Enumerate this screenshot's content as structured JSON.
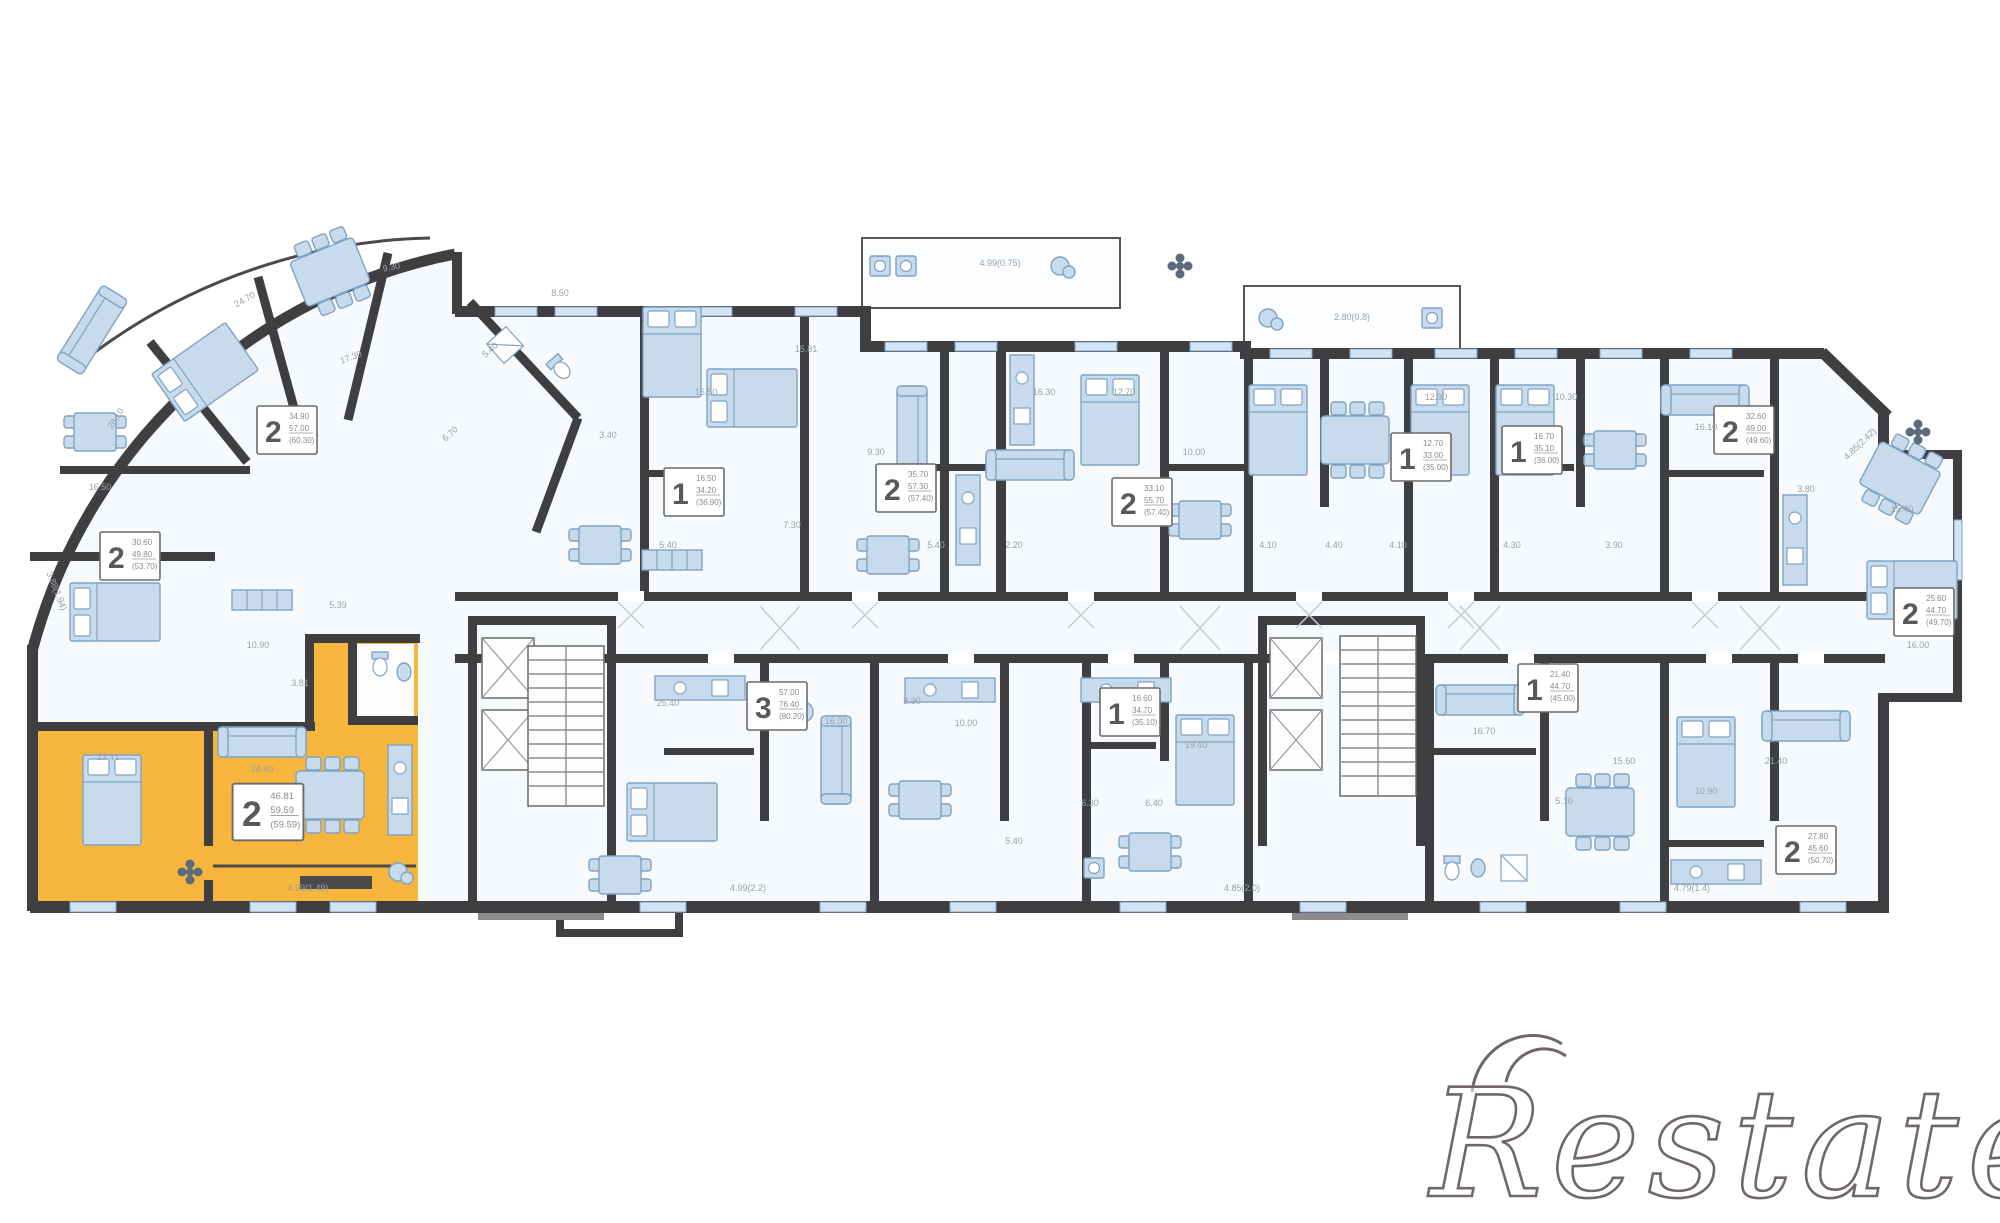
{
  "watermark": {
    "text": "Restate"
  },
  "plan": {
    "colors": {
      "wall": "#3f3f41",
      "furniture": "#c7dbec",
      "highlight": "#F6B53C",
      "dim_text": "#9aa1a8",
      "watermark": "#6f6866"
    },
    "units": [
      {
        "rooms": "2",
        "x": 287,
        "y": 430,
        "lines": [
          "34.90",
          "57.00",
          "(60.30)"
        ],
        "highlight": false
      },
      {
        "rooms": "2",
        "x": 130,
        "y": 556,
        "lines": [
          "30.60",
          "49.80",
          "(53.70)"
        ],
        "highlight": false
      },
      {
        "rooms": "1",
        "x": 694,
        "y": 492,
        "lines": [
          "16.50",
          "34.20",
          "(36.90)"
        ],
        "highlight": false
      },
      {
        "rooms": "2",
        "x": 906,
        "y": 488,
        "lines": [
          "35.70",
          "57.30",
          "(57.40)"
        ],
        "highlight": false
      },
      {
        "rooms": "2",
        "x": 1142,
        "y": 502,
        "lines": [
          "33.10",
          "55.70",
          "(57.40)"
        ],
        "highlight": false
      },
      {
        "rooms": "1",
        "x": 1421,
        "y": 457,
        "lines": [
          "12.70",
          "33.00",
          "(35.00)"
        ],
        "highlight": false
      },
      {
        "rooms": "1",
        "x": 1532,
        "y": 450,
        "lines": [
          "16.70",
          "35.10",
          "(36.00)"
        ],
        "highlight": false
      },
      {
        "rooms": "2",
        "x": 1744,
        "y": 430,
        "lines": [
          "32.60",
          "49.00",
          "(49.60)"
        ],
        "highlight": false
      },
      {
        "rooms": "2",
        "x": 1924,
        "y": 612,
        "lines": [
          "25.60",
          "44.70",
          "(49.70)"
        ],
        "highlight": false
      },
      {
        "rooms": "2",
        "x": 268,
        "y": 812,
        "lines": [
          "46.81",
          "59.59",
          "(59.59)"
        ],
        "highlight": true
      },
      {
        "rooms": "3",
        "x": 777,
        "y": 706,
        "lines": [
          "57.00",
          "76.40",
          "(80.20)"
        ],
        "highlight": false
      },
      {
        "rooms": "1",
        "x": 1130,
        "y": 712,
        "lines": [
          "16.60",
          "34.70",
          "(35.10)"
        ],
        "highlight": false
      },
      {
        "rooms": "1",
        "x": 1548,
        "y": 688,
        "lines": [
          "21.40",
          "44.70",
          "(45.00)"
        ],
        "highlight": false
      },
      {
        "rooms": "2",
        "x": 1806,
        "y": 850,
        "lines": [
          "27.80",
          "45.60",
          "(50.70)"
        ],
        "highlight": false
      }
    ],
    "dims": [
      {
        "t": "28.10",
        "x": 118,
        "y": 420,
        "r": -58
      },
      {
        "t": "24.70",
        "x": 246,
        "y": 302,
        "r": -30
      },
      {
        "t": "9.30",
        "x": 392,
        "y": 270,
        "r": -12
      },
      {
        "t": "17.30",
        "x": 352,
        "y": 360,
        "r": -20
      },
      {
        "t": "16.50",
        "x": 100,
        "y": 490
      },
      {
        "t": "3.88(1.94)",
        "x": 54,
        "y": 592,
        "r": 68
      },
      {
        "t": "10.90",
        "x": 258,
        "y": 648
      },
      {
        "t": "5.39",
        "x": 338,
        "y": 608
      },
      {
        "t": "3.81",
        "x": 300,
        "y": 686
      },
      {
        "t": "23.41",
        "x": 108,
        "y": 760
      },
      {
        "t": "24.40",
        "x": 262,
        "y": 772
      },
      {
        "t": "4.99(1.49)",
        "x": 308,
        "y": 891
      },
      {
        "t": "6.70",
        "x": 452,
        "y": 436,
        "r": -42
      },
      {
        "t": "5.40",
        "x": 492,
        "y": 352,
        "r": -42
      },
      {
        "t": "8.50",
        "x": 560,
        "y": 296
      },
      {
        "t": "3.40",
        "x": 608,
        "y": 438
      },
      {
        "t": "16.50",
        "x": 706,
        "y": 395
      },
      {
        "t": "5.40",
        "x": 668,
        "y": 548
      },
      {
        "t": "7.30",
        "x": 792,
        "y": 528
      },
      {
        "t": "15.81",
        "x": 806,
        "y": 352
      },
      {
        "t": "9.30",
        "x": 876,
        "y": 455
      },
      {
        "t": "5.40",
        "x": 936,
        "y": 548
      },
      {
        "t": "2.20",
        "x": 1014,
        "y": 548
      },
      {
        "t": "16.30",
        "x": 1044,
        "y": 395
      },
      {
        "t": "12.70",
        "x": 1124,
        "y": 395
      },
      {
        "t": "10.00",
        "x": 1194,
        "y": 455
      },
      {
        "t": "4.10",
        "x": 1268,
        "y": 548
      },
      {
        "t": "4.40",
        "x": 1334,
        "y": 548
      },
      {
        "t": "4.10",
        "x": 1398,
        "y": 548
      },
      {
        "t": "12.30",
        "x": 1436,
        "y": 400
      },
      {
        "t": "4.30",
        "x": 1512,
        "y": 548
      },
      {
        "t": "10.30",
        "x": 1566,
        "y": 400
      },
      {
        "t": "3.90",
        "x": 1614,
        "y": 548
      },
      {
        "t": "16.10",
        "x": 1706,
        "y": 430
      },
      {
        "t": "3.80",
        "x": 1806,
        "y": 492
      },
      {
        "t": "15.40",
        "x": 1902,
        "y": 512
      },
      {
        "t": "16.00",
        "x": 1918,
        "y": 648
      },
      {
        "t": "4.85(2.42)",
        "x": 1862,
        "y": 446,
        "r": -44
      },
      {
        "t": "4.99(0.75)",
        "x": 1000,
        "y": 266
      },
      {
        "t": "2.80(0.8)",
        "x": 1352,
        "y": 320
      },
      {
        "t": "25.40",
        "x": 668,
        "y": 706
      },
      {
        "t": "16.00",
        "x": 836,
        "y": 724
      },
      {
        "t": "8.30",
        "x": 912,
        "y": 704
      },
      {
        "t": "10.00",
        "x": 966,
        "y": 726
      },
      {
        "t": "5.40",
        "x": 1014,
        "y": 844
      },
      {
        "t": "6.40",
        "x": 1154,
        "y": 806
      },
      {
        "t": "19.40",
        "x": 1196,
        "y": 748
      },
      {
        "t": "6.30",
        "x": 1090,
        "y": 806
      },
      {
        "t": "16.70",
        "x": 1484,
        "y": 734
      },
      {
        "t": "5.10",
        "x": 1564,
        "y": 804
      },
      {
        "t": "15.60",
        "x": 1624,
        "y": 764
      },
      {
        "t": "10.90",
        "x": 1706,
        "y": 794
      },
      {
        "t": "21.40",
        "x": 1776,
        "y": 764
      },
      {
        "t": "4.99(2.2)",
        "x": 748,
        "y": 891
      },
      {
        "t": "4.85(2.0)",
        "x": 1242,
        "y": 891
      },
      {
        "t": "4.79(1.4)",
        "x": 1692,
        "y": 891
      }
    ]
  }
}
